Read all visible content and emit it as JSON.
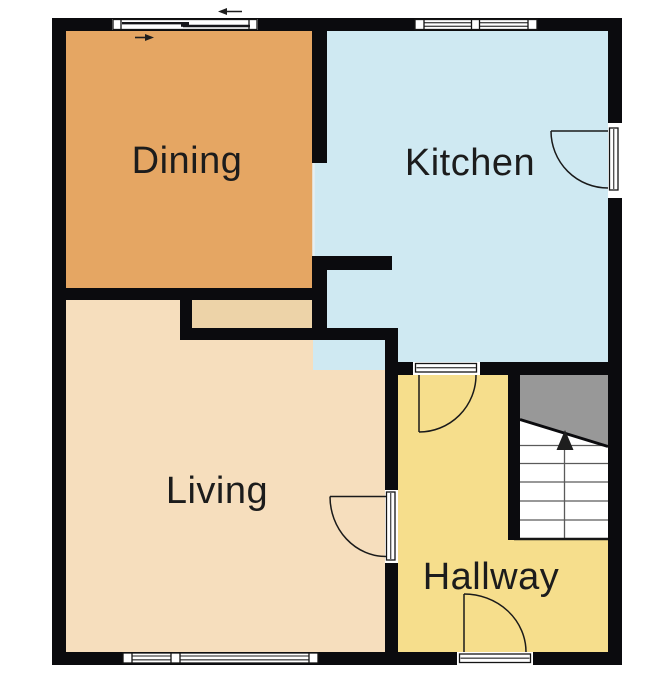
{
  "rooms": [
    {
      "id": "dining",
      "label": "Dining"
    },
    {
      "id": "kitchen",
      "label": "Kitchen"
    },
    {
      "id": "living",
      "label": "Living"
    },
    {
      "id": "hallway",
      "label": "Hallway"
    }
  ],
  "stairs": {
    "direction": "up",
    "arrow_icon": "up-arrow"
  },
  "sliding_door": {
    "arrow_icons": [
      "left-arrow",
      "right-arrow"
    ]
  },
  "colors": {
    "wall": "#0B0B0E",
    "room-dining": "#E5A663",
    "room-kitchen": "#CFE9F2",
    "room-living": "#F6DEBD",
    "room-hallway": "#F6DE8C",
    "passage": "#EDD3A8",
    "stairs-upper": "#989898",
    "label": "#1C1C1C",
    "background": "#FFFFFF"
  }
}
